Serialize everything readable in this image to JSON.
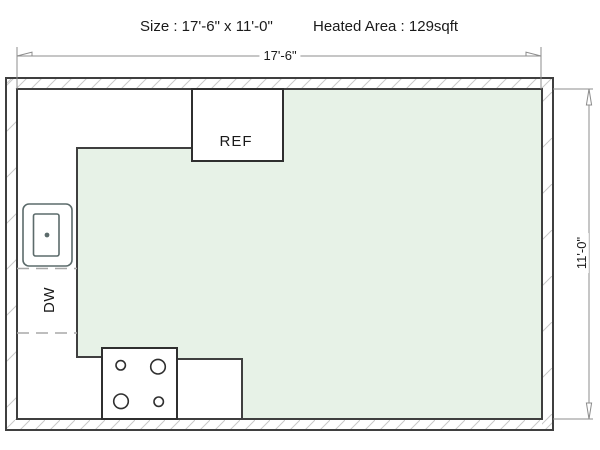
{
  "header": {
    "size_label": "Size : 17'-6\" x 11'-0\"",
    "heated_area_label": "Heated Area : 129sqft"
  },
  "dimensions": {
    "width_label": "17'-6\"",
    "height_label": "11'-0\""
  },
  "labels": {
    "refrigerator": "REF",
    "dishwasher": "DW"
  },
  "colors": {
    "bg": "#ffffff",
    "text-color": "#1a1a1a",
    "heated-fill": "#e7f2e7",
    "wall-line": "#3f3f3f",
    "fixture-line": "#2f2f2f",
    "sink-line": "#5c6b6b",
    "hatch-line": "#c9c9c9",
    "dash-line": "#a8a8a8",
    "dim-line": "#8c8c8c"
  }
}
